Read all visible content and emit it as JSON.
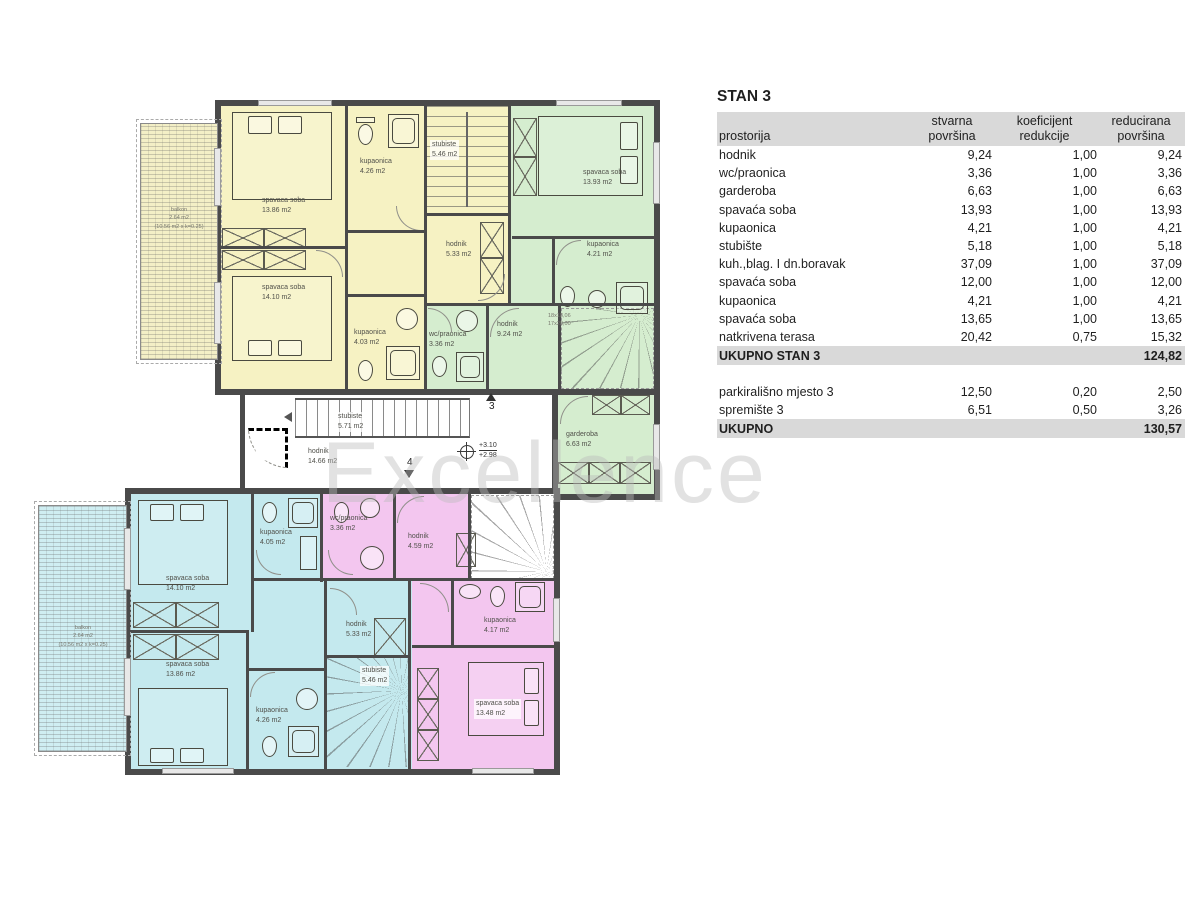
{
  "watermark": "Excellence",
  "colors": {
    "yellow": "#f6f2c3",
    "green": "#d5edcf",
    "cyan": "#c4e9ee",
    "pink": "#f3c6ef",
    "wall": "#4a4a4a",
    "table_band": "#d9d9d9"
  },
  "plan": {
    "rooms": {
      "u_bed1": {
        "name": "spavaca soba",
        "area": "13.86 m2"
      },
      "u_bath1": {
        "name": "kupaonica",
        "area": "4.26 m2"
      },
      "u_stairs": {
        "name": "stubiste",
        "area": "5.46 m2"
      },
      "u_bed2": {
        "name": "spavaca soba",
        "area": "14.10 m2"
      },
      "u_hall": {
        "name": "hodnik",
        "area": "5.33 m2"
      },
      "u_bath2": {
        "name": "kupaonica",
        "area": "4.03 m2"
      },
      "g_bed": {
        "name": "spavaca soba",
        "area": "13.93 m2"
      },
      "g_bath": {
        "name": "kupaonica",
        "area": "4.21 m2"
      },
      "g_wc": {
        "name": "wc/praonica",
        "area": "3.36 m2"
      },
      "g_hall": {
        "name": "hodnik",
        "area": "9.24 m2"
      },
      "g_ward": {
        "name": "garderoba",
        "area": "6.63 m2"
      },
      "m_stairs": {
        "name": "stubiste",
        "area": "5.71 m2"
      },
      "m_hall": {
        "name": "hodnik",
        "area": "14.66 m2"
      },
      "c_bed1": {
        "name": "spavaca soba",
        "area": "14.10 m2"
      },
      "c_bath1": {
        "name": "kupaonica",
        "area": "4.05 m2"
      },
      "c_bed2": {
        "name": "spavaca soba",
        "area": "13.86 m2"
      },
      "c_bath2": {
        "name": "kupaonica",
        "area": "4.26 m2"
      },
      "c_hall": {
        "name": "hodnik",
        "area": "5.33 m2"
      },
      "c_stairs": {
        "name": "stubiste",
        "area": "5.46 m2"
      },
      "p_wc": {
        "name": "wc/praonica",
        "area": "3.36 m2"
      },
      "p_hall": {
        "name": "hodnik",
        "area": "4.59 m2"
      },
      "p_bath": {
        "name": "kupaonica",
        "area": "4.17 m2"
      },
      "p_bed": {
        "name": "spavaca soba",
        "area": "13.48 m2"
      }
    },
    "balcony_upper": {
      "l1": "balkon",
      "l2": "2.64 m2",
      "l3": "(10.56 m2 x k=0.25)"
    },
    "balcony_lower": {
      "l1": "balkon",
      "l2": "2.64 m2",
      "l3": "(10.56 m2 x k=0.25)"
    },
    "stair_note": {
      "l1": "18x18,06",
      "l2": "17x28,00"
    },
    "markers": {
      "m3": "3",
      "m4": "4"
    },
    "levels": {
      "l1": "+3.10",
      "l2": "+2.98"
    }
  },
  "table": {
    "title": "STAN 3",
    "header": {
      "c1": "prostorija",
      "c2a": "stvarna",
      "c2b": "površina",
      "c3a": "koeficijent",
      "c3b": "redukcije",
      "c4a": "reducirana",
      "c4b": "površina"
    },
    "rows": [
      {
        "name": "hodnik",
        "a": "9,24",
        "k": "1,00",
        "r": "9,24"
      },
      {
        "name": "wc/praonica",
        "a": "3,36",
        "k": "1,00",
        "r": "3,36"
      },
      {
        "name": "garderoba",
        "a": "6,63",
        "k": "1,00",
        "r": "6,63"
      },
      {
        "name": "spavaća soba",
        "a": "13,93",
        "k": "1,00",
        "r": "13,93"
      },
      {
        "name": "kupaonica",
        "a": "4,21",
        "k": "1,00",
        "r": "4,21"
      },
      {
        "name": "stubište",
        "a": "5,18",
        "k": "1,00",
        "r": "5,18"
      },
      {
        "name": "kuh.,blag. I dn.boravak",
        "a": "37,09",
        "k": "1,00",
        "r": "37,09"
      },
      {
        "name": "spavaća soba",
        "a": "12,00",
        "k": "1,00",
        "r": "12,00"
      },
      {
        "name": "kupaonica",
        "a": "4,21",
        "k": "1,00",
        "r": "4,21"
      },
      {
        "name": "spavaća soba",
        "a": "13,65",
        "k": "1,00",
        "r": "13,65"
      },
      {
        "name": "natkrivena terasa",
        "a": "20,42",
        "k": "0,75",
        "r": "15,32"
      }
    ],
    "subtotal": {
      "label": "UKUPNO STAN 3",
      "value": "124,82"
    },
    "extra_rows": [
      {
        "name": "parkirališno mjesto 3",
        "a": "12,50",
        "k": "0,20",
        "r": "2,50"
      },
      {
        "name": "spremište 3",
        "a": "6,51",
        "k": "0,50",
        "r": "3,26"
      }
    ],
    "total": {
      "label": "UKUPNO",
      "value": "130,57"
    }
  }
}
